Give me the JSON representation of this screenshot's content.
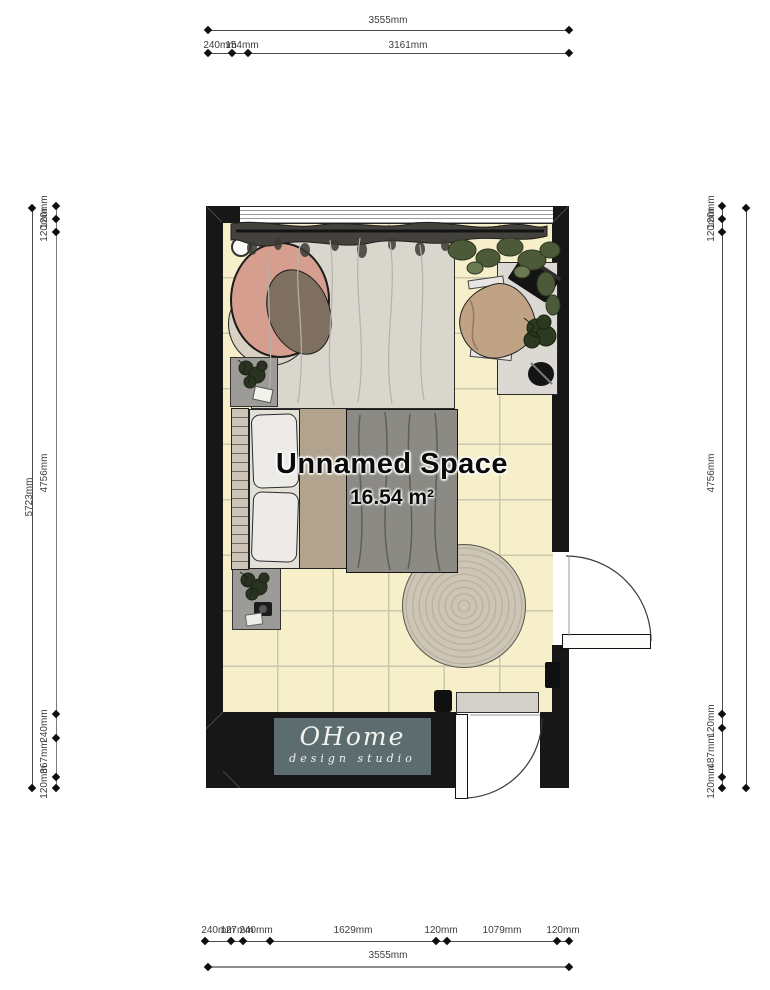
{
  "room": {
    "name": "Unnamed Space",
    "area": "16.54 m²"
  },
  "logo": {
    "name": "OHome",
    "subtitle": "design studio"
  },
  "dims": {
    "top_total": "3555mm",
    "top_segments": [
      "240mm",
      "154mm",
      "3161mm"
    ],
    "bottom_segments": [
      "240mm",
      "127mm",
      "240mm",
      "1629mm",
      "120mm",
      "1079mm",
      "120mm"
    ],
    "bottom_total": "3555mm",
    "left_total": "5723mm",
    "left_segments": [
      "120mm",
      "120mm",
      "4756mm",
      "240mm",
      "367mm",
      "120mm"
    ],
    "right_segments": [
      "120mm",
      "120mm",
      "4756mm",
      "120mm",
      "487mm",
      "120mm"
    ],
    "right_total": "5723mm"
  },
  "colors": {
    "floor": "#f6efc9",
    "wall": "#171717",
    "logo_panel": "#5d6d6f",
    "chair_accent": "#d69e8e"
  }
}
